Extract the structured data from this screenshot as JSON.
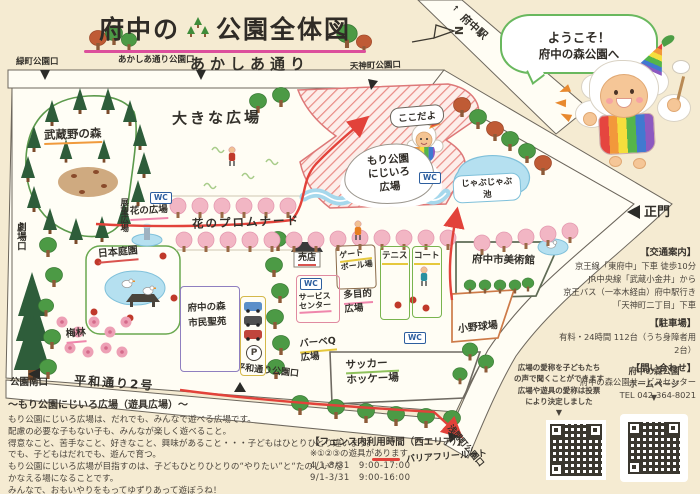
{
  "title": {
    "full": "府中の森公園全体図",
    "prefix": "府中の",
    "suffix": "公園全体図"
  },
  "compass": {
    "north": "N"
  },
  "welcome_bubble": {
    "line1": "ようこそ！",
    "line2": "府中の森公園へ"
  },
  "mascot": {
    "callout": "ここだよ"
  },
  "map": {
    "streets": {
      "akashia_dori": "あかしあ通り",
      "heiwa_dori": "平和通り2号",
      "fuchu_station": "府中駅",
      "station_arrow": "↑"
    },
    "entrances": {
      "midoricho": "緑町公園口",
      "akashia": "あかしあ通り公園口",
      "tenjincho": "天神町公園口",
      "main_gate": "正門",
      "theater": "劇場口",
      "south": "公園南口",
      "heiwadori": "平和通り公園口",
      "sengencho": "浅間町公園口"
    },
    "areas": {
      "musashino": "武蔵野の森",
      "big_plaza": "大きな広場",
      "flower_plaza": "花の広場",
      "promenade": "花のプロムナード",
      "observation": "展望広場",
      "japanese_garden": "日本庭園",
      "plum_grove": "梅林",
      "nijiiro_l1": "もり公園",
      "nijiiro_l2": "にじいろ",
      "nijiiro_l3": "広場",
      "jabujabu_l1": "じゃぶじゃぶ",
      "jabujabu_l2": "池",
      "multipurpose_l1": "多目的",
      "multipurpose_l2": "広場",
      "bbq_l1": "バーベQ",
      "bbq_l2": "広場"
    },
    "facilities": {
      "shop": "売店",
      "gateball_l1": "ゲート",
      "gateball_l2": "ボール場",
      "tennis": "テニス",
      "court": "コート",
      "service_l1": "サービス",
      "service_l2": "センター",
      "soccer_l1": "サッカー",
      "soccer_l2": "ホッケー場",
      "seien_l1": "府中の森",
      "seien_l2": "市民聖苑",
      "museum": "府中市美術館",
      "baseball": "小野球場"
    },
    "badges": {
      "wc": "WC",
      "parking": "P"
    }
  },
  "legend": {
    "barrier_free": "バリアフリールート"
  },
  "info_panel": {
    "access_heading": "【交通案内】",
    "access_lines": [
      "京王線「東府中」下車 徒歩10分",
      "JR中央線「武蔵小金井」から",
      "京王バス（一本木経由）府中駅行き",
      "「天神町二丁目」下車"
    ],
    "parking_heading": "【駐車場】",
    "parking_line": "有料・24時間 112台（うち身障者用2台）",
    "contact_heading": "【問い合わせ】",
    "contact_lines": [
      "府中の森公園サービスセンター",
      "TEL 042-364-8021"
    ]
  },
  "qr_section": {
    "nickname_note_lines": [
      "広場の愛称を子どもたち",
      "の声で聞くことができます",
      "広場や遊具の愛称は投票",
      "により決定しました"
    ],
    "homepage_label_lines": [
      "府中の森公園",
      "ホームページ"
    ],
    "arrow": "▼"
  },
  "nijiiro_note": {
    "heading": "〜もり公園にじいろ広場（遊具広場）〜",
    "lines": [
      "もり公園にじいろ広場は、だれでも、みんなで遊べる広場です。",
      "配慮の必要な子もない子も、みんなが楽しく遊べること。",
      "得意なこと、苦手なこと、好きなこと、興味があること・・・子どもはひとりひとり違います。",
      "でも、子どもはだれでも、遊んで育つ。",
      "もり公園にじいろ広場が目指すのは、子どもひとりひとりの“やりたい”と“たのしい”を",
      "かなえる場になることです。",
      "みんなで、おもいやりをもってゆずりあって遊ぼうね！"
    ]
  },
  "fence_info": {
    "heading": "【フェンス内利用時間（西エリア）】",
    "note": "※①②③の遊具があります",
    "schedule": [
      "4/1-8/31　9:00-17:00",
      "9/1-3/31　9:00-16:00"
    ]
  }
}
